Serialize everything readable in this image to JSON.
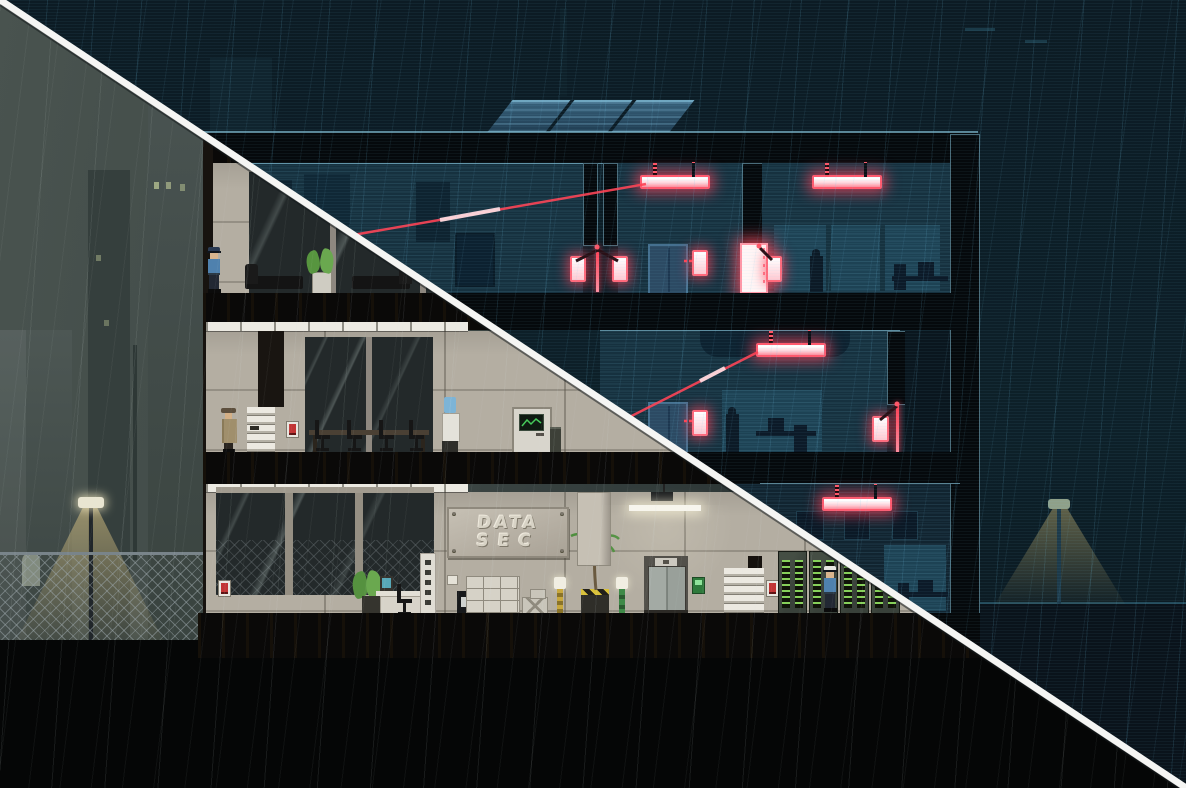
{
  "scene": {
    "type": "stealth-game-building-cross-section",
    "left_mode": "interior-lit-view",
    "right_mode": "night-security-view",
    "weather": "rain"
  },
  "sign": {
    "line1": "DATA",
    "line2": "SEC"
  },
  "palette": {
    "night_sky": "#0d1f29",
    "night_room": "#16313f",
    "night_panel": "#1d4254",
    "outline_blue": "#8fd0e8",
    "laser_red": "#ff4254",
    "glow_core": "#fff2f4",
    "concrete": "#b4aea2",
    "slab_black": "#0a0908",
    "split_line": "#f5f5f3",
    "alarm_red": "#c23434",
    "led_green": "#86d05a",
    "reader_green": "#2e7a3c",
    "monitor_teal": "#57a8b8",
    "lamp_cone": "#dbc484",
    "guard_shirt": "#4f81ae",
    "trench_coat": "#a08f6c"
  },
  "counts": {
    "floors": 3,
    "solar_panels": 3,
    "red_light_fixtures": 4,
    "laser_sensor_lamps": 6,
    "laser_beams": 2,
    "elevators": 3,
    "alarm_boxes": 3,
    "guards_lit": 2,
    "guards_silhouette": 2,
    "player_character": 1,
    "server_racks": 4,
    "street_lamps": 2
  },
  "objects": [
    "solar-panel",
    "red-light-fixture",
    "laser-sensor-lamp",
    "laser-beam",
    "security-elevator",
    "glow-door",
    "guard",
    "player-character",
    "couch",
    "potted-plant",
    "conference-table",
    "office-chair",
    "water-cooler",
    "security-door",
    "trash-can",
    "stairs",
    "alarm-box",
    "reception-desk",
    "computer-monitor",
    "sign-pillar",
    "info-kiosk",
    "datasec-sign",
    "filing-cabinet",
    "crates",
    "bollard-lamp",
    "palm-plant",
    "ceiling-duct",
    "ceiling-light",
    "elevator",
    "card-reader",
    "server-rack",
    "chain-link-fence",
    "street-lamp",
    "light-cone",
    "city-tower",
    "rain",
    "split-line"
  ]
}
